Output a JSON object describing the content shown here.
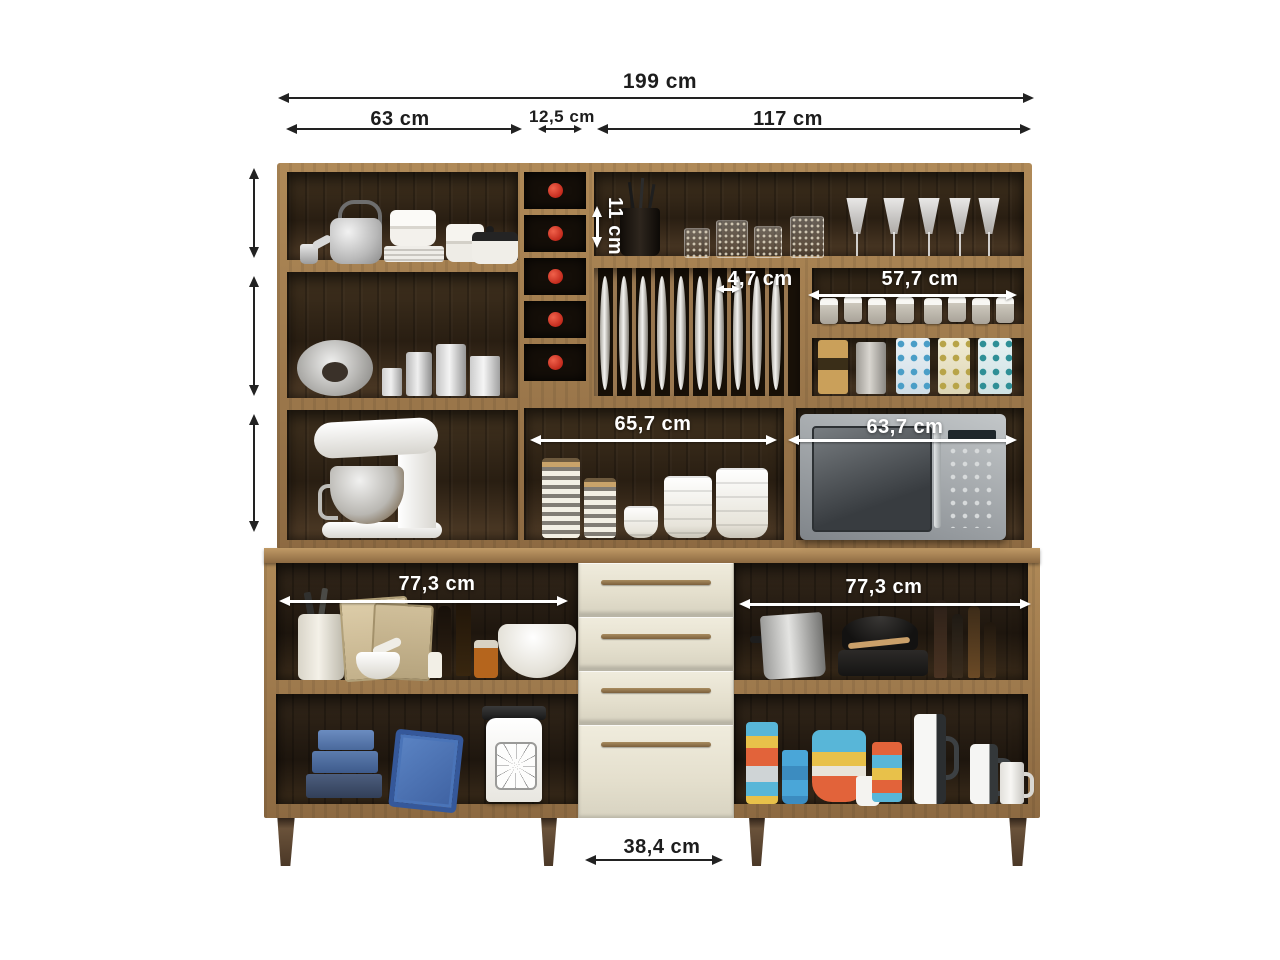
{
  "image": {
    "type": "product-dimension-diagram",
    "subject": "Kitchen cabinet unit with hutch, wine rack, plate rack, microwave niche and drawers"
  },
  "dimensions": {
    "total_width": "199 cm",
    "hutch_left_section_width": "63 cm",
    "wine_rack_width": "12,5 cm",
    "hutch_right_section_width": "117 cm",
    "top_niche_height": "11 cm",
    "plate_rack_slot_width": "4,7 cm",
    "spice_shelf_width": "57,7 cm",
    "center_niche_width": "65,7 cm",
    "microwave_niche_width": "63,7 cm",
    "base_left_section_width": "77,3 cm",
    "base_right_section_width": "77,3 cm",
    "drawer_section_width": "38,4 cm"
  },
  "colors": {
    "background": "#ffffff",
    "wood_frame": "#9a7549",
    "interior_dark": "#2f2315",
    "drawer_front": "#e9e4d3",
    "handle_bronze": "#8f7450",
    "wine_bottle_cap": "#d0301d",
    "dimension_text_dark": "#1d1d1d",
    "dimension_text_light": "#ffffff"
  }
}
